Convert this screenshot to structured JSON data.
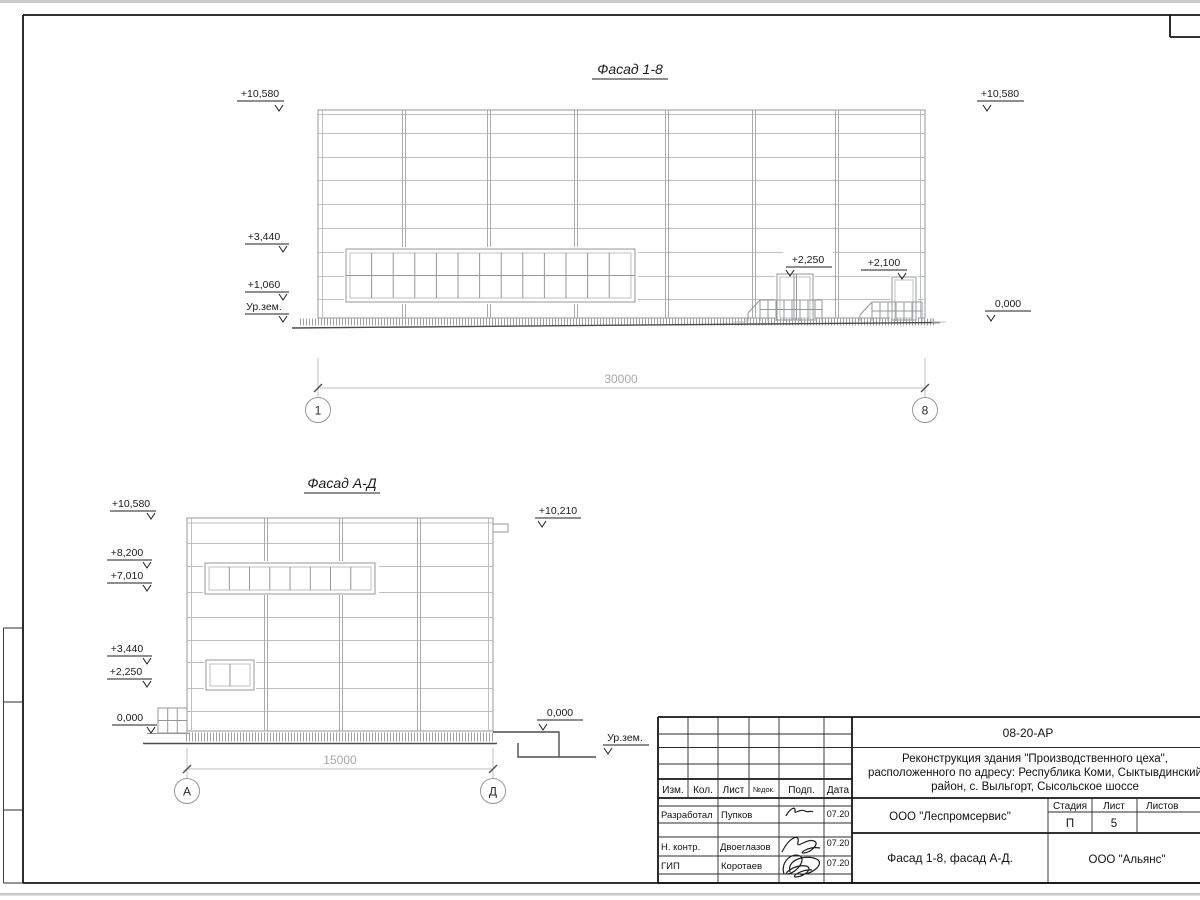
{
  "colors": {
    "line_light": "#bdc0c2",
    "line_mid": "#95989a",
    "line_dark": "#4a4d4f",
    "line_black": "#1c1c1c",
    "dim_text": "#a8a8a8",
    "hatch": "#9ea2a4",
    "paper": "#ffffff",
    "chrome": "#c9c9c9"
  },
  "facade_1_8": {
    "title": "Фасад 1-8",
    "marks": {
      "top_left": "+10,580",
      "top_right": "+10,580",
      "m3440": "+3,440",
      "m1060": "+1,060",
      "ground_left": "Ур.зем.",
      "zero_right": "0,000",
      "door1": "+2,250",
      "door2": "+2,100"
    },
    "dimension": "30000",
    "axis_left": "1",
    "axis_right": "8"
  },
  "facade_a_d": {
    "title": "Фасад А-Д",
    "marks": {
      "m10580": "+10,580",
      "m8200": "+8,200",
      "m7010": "+7,010",
      "m3440": "+3,440",
      "m2250": "+2,250",
      "zero_left": "0,000",
      "m10210": "+10,210",
      "zero_right": "0,000",
      "ground_right": "Ур.зем."
    },
    "dimension": "15000",
    "axis_left": "А",
    "axis_right": "Д"
  },
  "title_block": {
    "code": "08-20-АР",
    "project_line1": "Реконструкция здания \"Производственного цеха\",",
    "project_line2": "расположенного по адресу: Республика Коми, Сыктывдинский",
    "project_line3": "район, с. Выльгорт, Сысольское шоссе",
    "header": [
      "Изм.",
      "Кол.",
      "Лист",
      "№док.",
      "Подп.",
      "Дата"
    ],
    "rows": [
      {
        "role": "Разработал",
        "name": "Пупков",
        "date": "07.20"
      },
      {
        "role": "Н. контр.",
        "name": "Двоеглазов",
        "date": "07.20"
      },
      {
        "role": "ГИП",
        "name": "Коротаев",
        "date": "07.20"
      }
    ],
    "company": "ООО \"Леспромсервис\"",
    "stage_header": {
      "stage": "Стадия",
      "sheet": "Лист",
      "sheets": "Листов"
    },
    "stage_value": "П",
    "sheet_value": "5",
    "drawing_title": "Фасад 1-8, фасад А-Д.",
    "contractor": "ООО \"Альянс\""
  }
}
